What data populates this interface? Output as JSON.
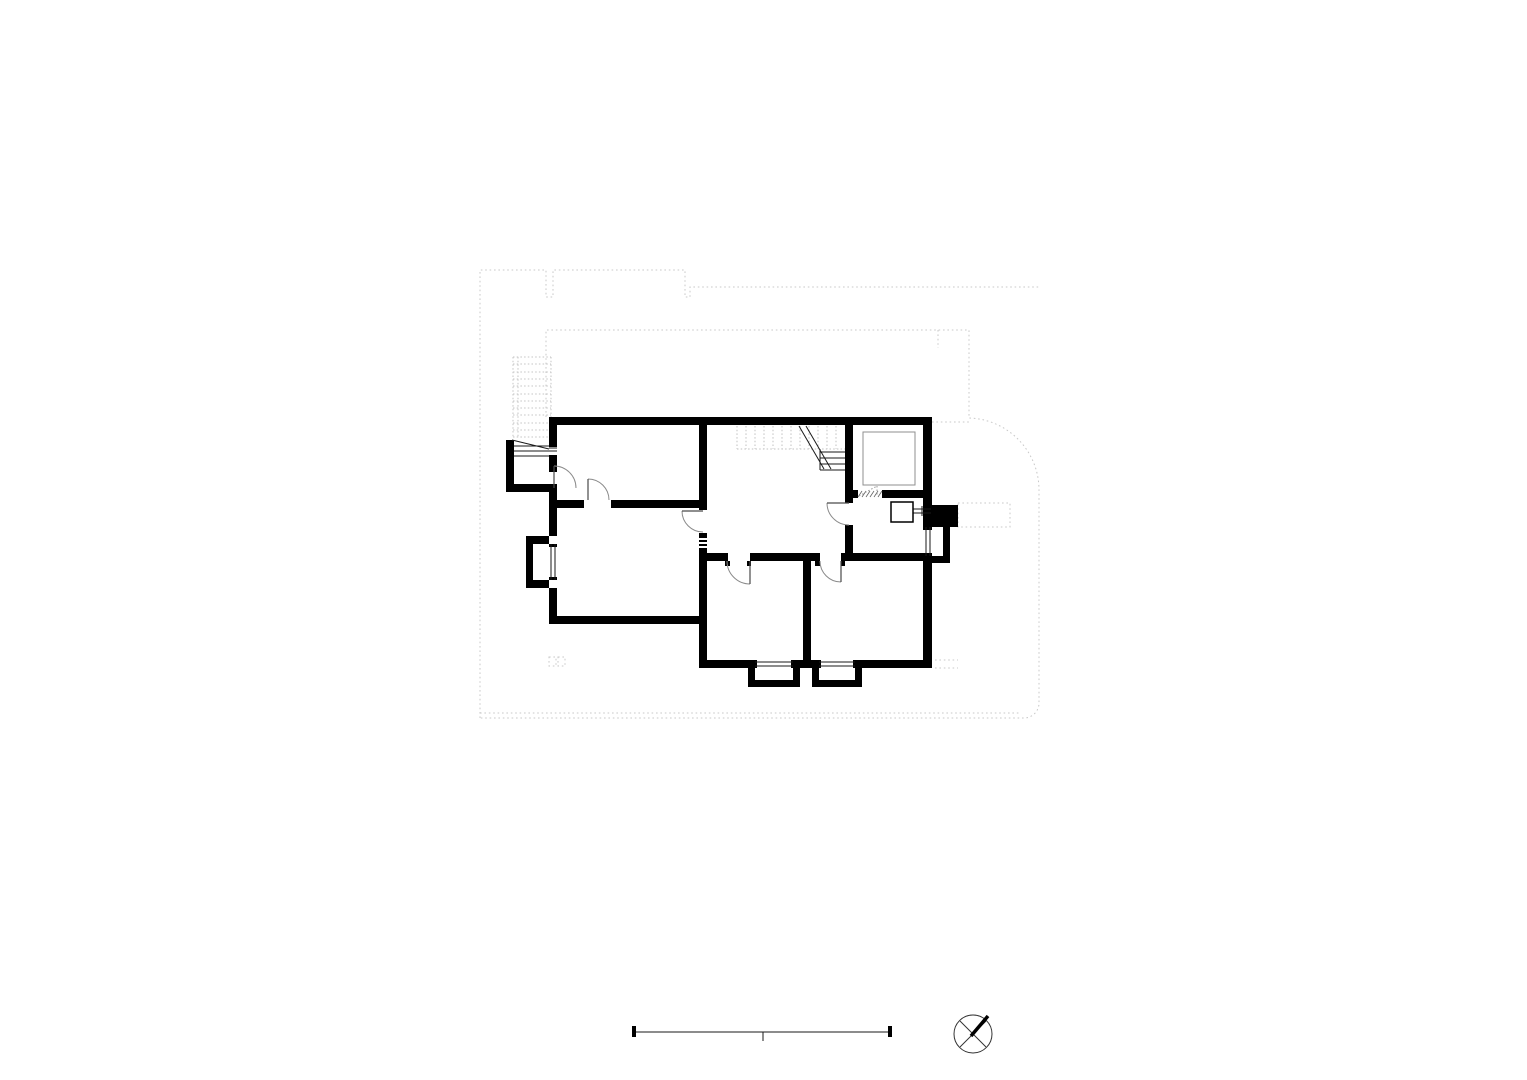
{
  "meta": {
    "drawing_type": "architectural-floor-plan",
    "canvas": {
      "width": 1527,
      "height": 1080
    },
    "background": "#ffffff"
  },
  "palette": {
    "wall": "#000000",
    "thin": "#1a1a1a",
    "leaf": "#4a4a4a",
    "arc": "#8a8a8a",
    "dashed": "#c8c8c8",
    "dashed2": "#c4c4c4",
    "dashed3": "#c0c0c0",
    "fixture": "#8f8f8f",
    "hatch": "#666666",
    "dotdoor": "#999999",
    "dark": "#333333",
    "white": "#ffffff"
  },
  "layers": [
    {
      "name": "site-outline-dotted",
      "kind": "paths",
      "color": "dashed",
      "width": 1,
      "dash": "1.6 2.8",
      "items": [
        "M480,718L480,270L546,270L546,297L553,297L553,270L685,270L685,297L690,297L690,287L1039,287",
        "M546,417L546,330L969,330L969,418A72,72 0 0 1 1039,490L1039,703A15,15 0 0 1 1024,718L480,718",
        "M938,330L938,348",
        "M932,422L969,422",
        "M958,503h52v24h-52Z",
        "M935,660h23",
        "M935,668h23",
        "M549,657h7v9h-7Z",
        "M558,657h7v9h-7Z",
        "M480,713L1020,713"
      ]
    },
    {
      "name": "exterior-stair-dotted",
      "kind": "lines",
      "color": "dashed2",
      "width": 1,
      "dash": "1.5 2.2",
      "items": [
        [
          513,
          357,
          513,
          437
        ],
        [
          518,
          357,
          518,
          437
        ],
        [
          551,
          357,
          551,
          417
        ],
        [
          513,
          357,
          551,
          357
        ],
        [
          513,
          364,
          551,
          364
        ],
        [
          513,
          372,
          551,
          372
        ],
        [
          513,
          379,
          551,
          379
        ],
        [
          513,
          386,
          551,
          386
        ],
        [
          513,
          394,
          551,
          394
        ],
        [
          513,
          401,
          551,
          401
        ],
        [
          513,
          408,
          551,
          408
        ],
        [
          513,
          415,
          551,
          415
        ],
        [
          513,
          423,
          551,
          423
        ],
        [
          513,
          430,
          551,
          430
        ],
        [
          513,
          437,
          551,
          437
        ]
      ]
    },
    {
      "name": "stair-upper-flight-dotted",
      "kind": "lines",
      "color": "dashed3",
      "width": 1,
      "dash": "1.5 2.2",
      "items": [
        [
          737,
          426,
          737,
          449
        ],
        [
          746,
          426,
          746,
          449
        ],
        [
          755,
          426,
          755,
          449
        ],
        [
          764,
          426,
          764,
          449
        ],
        [
          773,
          426,
          773,
          449
        ],
        [
          782,
          426,
          782,
          449
        ],
        [
          791,
          426,
          791,
          449
        ],
        [
          800,
          426,
          800,
          449
        ],
        [
          809,
          426,
          809,
          449
        ],
        [
          818,
          426,
          818,
          449
        ],
        [
          827,
          426,
          827,
          449
        ],
        [
          836,
          426,
          836,
          449
        ],
        [
          737,
          449,
          845,
          449
        ]
      ]
    },
    {
      "name": "walls",
      "kind": "rects",
      "color": "wall",
      "items": [
        [
          549,
          417,
          383,
          8
        ],
        [
          549,
          425,
          8,
          20
        ],
        [
          549,
          444,
          8,
          3
        ],
        [
          549,
          455,
          8,
          3
        ],
        [
          549,
          458,
          8,
          14
        ],
        [
          506,
          440,
          8,
          52
        ],
        [
          506,
          484,
          51,
          8
        ],
        [
          549,
          488,
          8,
          48
        ],
        [
          526,
          536,
          23,
          8
        ],
        [
          526,
          536,
          7,
          52
        ],
        [
          526,
          580,
          23,
          8
        ],
        [
          549,
          544,
          8,
          3
        ],
        [
          549,
          577,
          8,
          3
        ],
        [
          549,
          588,
          8,
          36
        ],
        [
          549,
          616,
          158,
          8
        ],
        [
          549,
          500,
          35,
          8
        ],
        [
          611,
          500,
          96,
          8
        ],
        [
          699,
          425,
          8,
          85
        ],
        [
          699,
          533,
          8,
          135
        ],
        [
          707,
          553,
          21,
          8
        ],
        [
          750,
          553,
          70,
          8
        ],
        [
          841,
          553,
          91,
          8
        ],
        [
          725,
          561,
          5,
          5
        ],
        [
          747,
          561,
          4,
          5
        ],
        [
          815,
          561,
          5,
          5
        ],
        [
          841,
          561,
          4,
          5
        ],
        [
          803,
          561,
          8,
          99
        ],
        [
          699,
          660,
          56,
          8
        ],
        [
          748,
          668,
          7,
          16
        ],
        [
          748,
          680,
          52,
          7
        ],
        [
          793,
          668,
          7,
          16
        ],
        [
          753,
          660,
          4,
          8
        ],
        [
          791,
          660,
          4,
          8
        ],
        [
          793,
          660,
          26,
          8
        ],
        [
          812,
          668,
          7,
          16
        ],
        [
          812,
          680,
          50,
          7
        ],
        [
          855,
          668,
          7,
          16
        ],
        [
          817,
          660,
          4,
          8
        ],
        [
          853,
          660,
          4,
          8
        ],
        [
          855,
          660,
          77,
          8
        ],
        [
          923,
          425,
          9,
          102
        ],
        [
          923,
          556,
          9,
          112
        ],
        [
          932,
          505,
          26,
          22
        ],
        [
          943,
          527,
          7,
          36
        ],
        [
          932,
          556,
          18,
          7
        ],
        [
          923,
          527,
          9,
          3
        ],
        [
          923,
          553,
          9,
          3
        ],
        [
          845,
          425,
          8,
          65
        ],
        [
          845,
          490,
          13,
          8
        ],
        [
          882,
          490,
          50,
          8
        ],
        [
          845,
          498,
          8,
          5
        ],
        [
          845,
          525,
          8,
          28
        ]
      ]
    },
    {
      "name": "wall-vent-slits",
      "kind": "lines",
      "color": "white",
      "width": 2,
      "items": [
        [
          699,
          539,
          707,
          539
        ],
        [
          699,
          543,
          707,
          543
        ],
        [
          699,
          547,
          707,
          547
        ]
      ]
    },
    {
      "name": "thin-detail-lines",
      "kind": "lines",
      "color": "thin",
      "width": 1,
      "items": [
        [
          549,
          448,
          557,
          448
        ],
        [
          549,
          451,
          557,
          451
        ],
        [
          514,
          446,
          549,
          446
        ],
        [
          514,
          451,
          549,
          451
        ],
        [
          514,
          456,
          549,
          456
        ],
        [
          512,
          440,
          549,
          449
        ],
        [
          551,
          544,
          551,
          580
        ],
        [
          555,
          544,
          555,
          580
        ],
        [
          926,
          527,
          926,
          556
        ],
        [
          930,
          527,
          930,
          556
        ],
        [
          755,
          662,
          793,
          662
        ],
        [
          755,
          666,
          793,
          666
        ],
        [
          819,
          662,
          855,
          662
        ],
        [
          819,
          666,
          855,
          666
        ],
        [
          820,
          452,
          845,
          452
        ],
        [
          820,
          458,
          845,
          458
        ],
        [
          820,
          464,
          845,
          464
        ],
        [
          820,
          470,
          845,
          470
        ],
        [
          820,
          449,
          820,
          470
        ],
        [
          799,
          426,
          824,
          469
        ],
        [
          806,
          426,
          831,
          469
        ],
        [
          913,
          509,
          931,
          509
        ],
        [
          913,
          513,
          931,
          513
        ],
        [
          922,
          506,
          922,
          516
        ]
      ]
    },
    {
      "name": "bath-platform-outline",
      "kind": "paths",
      "color": "fixture",
      "width": 1,
      "items": [
        "M863,432h52v53h-52Z"
      ]
    },
    {
      "name": "sink-fixture",
      "kind": "paths",
      "color": "wall",
      "width": 1.5,
      "items": [
        "M891,502h22v20h-22Z"
      ]
    },
    {
      "name": "door-threshold-hatch",
      "kind": "lines",
      "color": "hatch",
      "width": 0.8,
      "items": [
        [
          858,
          497,
          862,
          491
        ],
        [
          862,
          497,
          866,
          491
        ],
        [
          866,
          497,
          870,
          491
        ],
        [
          870,
          497,
          874,
          491
        ],
        [
          874,
          497,
          878,
          491
        ],
        [
          878,
          497,
          882,
          491
        ]
      ]
    },
    {
      "name": "dotted-door-swing",
      "kind": "lines",
      "color": "dotdoor",
      "width": 1,
      "dash": "1.5 2",
      "items": [
        [
          859,
          496,
          877,
          486
        ],
        [
          877,
          486,
          877,
          496
        ]
      ]
    },
    {
      "name": "door-swing-arcs",
      "kind": "paths",
      "color": "arc",
      "width": 1,
      "items": [
        "M554,466A22,22 0 0 1 576,488",
        "M588,479A21,21 0 0 1 609,500",
        "M682,511A21,21 0 0 0 703,532",
        "M827,503A22,22 0 0 0 849,525",
        "M727,561A23,23 0 0 0 750,584",
        "M820,561A21,21 0 0 0 841,582"
      ]
    },
    {
      "name": "door-leaves",
      "kind": "lines",
      "color": "leaf",
      "width": 1.2,
      "items": [
        [
          554,
          466,
          554,
          488
        ],
        [
          588,
          479,
          588,
          500
        ],
        [
          682,
          511,
          703,
          511
        ],
        [
          827,
          503,
          849,
          503
        ],
        [
          750,
          561,
          750,
          584
        ],
        [
          841,
          561,
          841,
          582
        ]
      ]
    },
    {
      "name": "scale-bar-line",
      "kind": "lines",
      "color": "thin",
      "width": 1,
      "items": [
        [
          635,
          1032,
          891,
          1032
        ],
        [
          763,
          1032,
          763,
          1041
        ]
      ]
    },
    {
      "name": "scale-bar-ticks",
      "kind": "rects",
      "color": "wall",
      "items": [
        [
          632,
          1026,
          4,
          11
        ],
        [
          888,
          1026,
          4,
          11
        ]
      ]
    },
    {
      "name": "north-arrow-circle",
      "kind": "circles",
      "color": "dark",
      "fill": "white",
      "width": 1,
      "items": [
        [
          973,
          1034,
          19
        ]
      ]
    },
    {
      "name": "north-arrow-cross-lines",
      "kind": "lines",
      "color": "dark",
      "width": 1,
      "items": [
        [
          960,
          1021,
          986,
          1047
        ],
        [
          960,
          1047,
          986,
          1021
        ]
      ]
    },
    {
      "name": "north-arrow-needle",
      "kind": "lines",
      "color": "wall",
      "width": 3.5,
      "items": [
        [
          971,
          1036,
          988,
          1016
        ]
      ]
    }
  ]
}
